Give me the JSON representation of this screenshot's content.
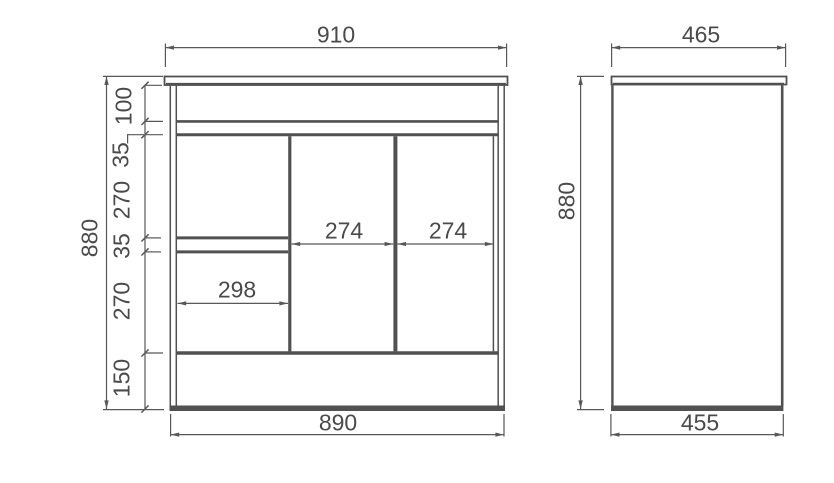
{
  "front_view": {
    "width_top": "910",
    "width_bottom": "890",
    "height": "880",
    "vertical_chain": [
      "100",
      "35",
      "270",
      "35",
      "270",
      "150"
    ],
    "drawer_width": "298",
    "door_widths": [
      "274",
      "274"
    ]
  },
  "side_view": {
    "width_top": "465",
    "width_bottom": "455",
    "height": "880"
  }
}
